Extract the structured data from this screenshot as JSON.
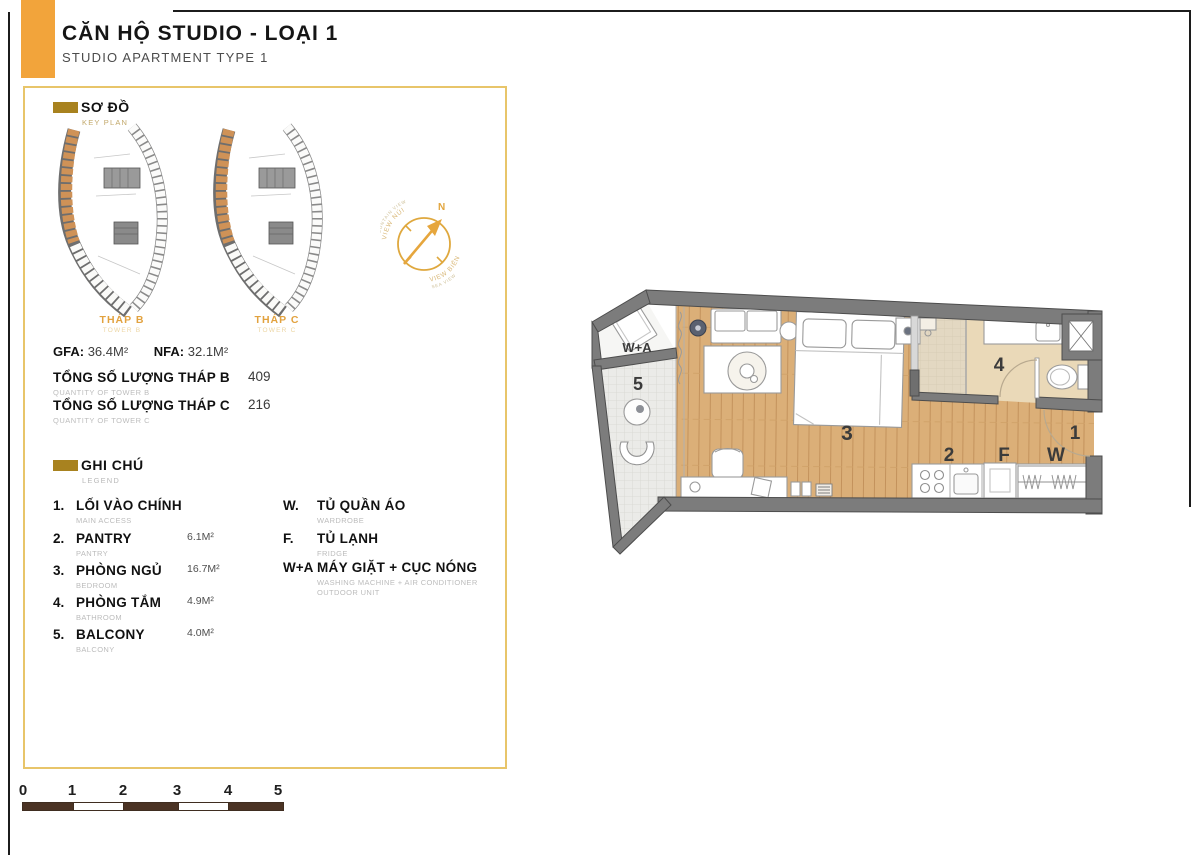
{
  "header": {
    "title": "CĂN HỘ STUDIO - LOẠI 1",
    "subtitle": "STUDIO APARTMENT TYPE 1"
  },
  "key_plan": {
    "label": "SƠ ĐỒ",
    "sublabel": "KEY PLAN",
    "towers": [
      {
        "name": "THÁP B",
        "subname": "TOWER B"
      },
      {
        "name": "THÁP C",
        "subname": "TOWER C"
      }
    ]
  },
  "compass": {
    "north": "N",
    "view_top": "VIEW NÚI",
    "view_top_sub": "MOUNTAIN VIEW",
    "view_bottom": "VIEW BIỂN",
    "view_bottom_sub": "SEA VIEW"
  },
  "stats": {
    "gfa_label": "GFA:",
    "gfa_value": "36.4M²",
    "nfa_label": "NFA:",
    "nfa_value": "32.1M²"
  },
  "quantities": [
    {
      "label": "TỔNG SỐ LƯỢNG THÁP B",
      "sublabel": "QUANTITY OF TOWER B",
      "value": "409"
    },
    {
      "label": "TỔNG SỐ LƯỢNG THÁP C",
      "sublabel": "QUANTITY OF TOWER C",
      "value": "216"
    }
  ],
  "legend": {
    "label": "GHI CHÚ",
    "sublabel": "LEGEND",
    "items_left": [
      {
        "key": "1.",
        "name": "LỐI VÀO CHÍNH",
        "subname": "MAIN ACCESS",
        "area": ""
      },
      {
        "key": "2.",
        "name": "PANTRY",
        "subname": "PANTRY",
        "area": "6.1M²"
      },
      {
        "key": "3.",
        "name": "PHÒNG NGỦ",
        "subname": "BEDROOM",
        "area": "16.7M²"
      },
      {
        "key": "4.",
        "name": "PHÒNG TẮM",
        "subname": "BATHROOM",
        "area": "4.9M²"
      },
      {
        "key": "5.",
        "name": "BALCONY",
        "subname": "BALCONY",
        "area": "4.0M²"
      }
    ],
    "items_right": [
      {
        "key": "W.",
        "name": "TỦ QUẦN ÁO",
        "subname": "WARDROBE",
        "subname2": ""
      },
      {
        "key": "F.",
        "name": "TỦ LẠNH",
        "subname": "FRIDGE",
        "subname2": ""
      },
      {
        "key": "W+A",
        "name": "MÁY GIẶT + CỤC NÓNG",
        "subname": "WASHING MACHINE + AIR CONDITIONER",
        "subname2": "OUTDOOR UNIT"
      }
    ]
  },
  "floor_plan": {
    "labels": {
      "entrance": "1",
      "pantry": "2",
      "bedroom": "3",
      "bathroom": "4",
      "balcony": "5",
      "wardrobe": "W",
      "fridge": "F",
      "washer_ac": "W+A"
    }
  },
  "scale_bar": {
    "ticks": [
      "0",
      "1",
      "2",
      "3",
      "4",
      "5"
    ]
  },
  "colors": {
    "accent_orange": "#F2A43B",
    "panel_border_gold": "#E8C56A",
    "header_icon_gold": "#A8821F",
    "tower_label_orange": "#E2A23F",
    "wall_gray": "#7C7C7C",
    "wood_floor": "#DBAF78",
    "keyplan_unit_orange": "#CF9257",
    "compass_orange": "#E2A53E",
    "scale_bar_brown": "#4B3324"
  }
}
